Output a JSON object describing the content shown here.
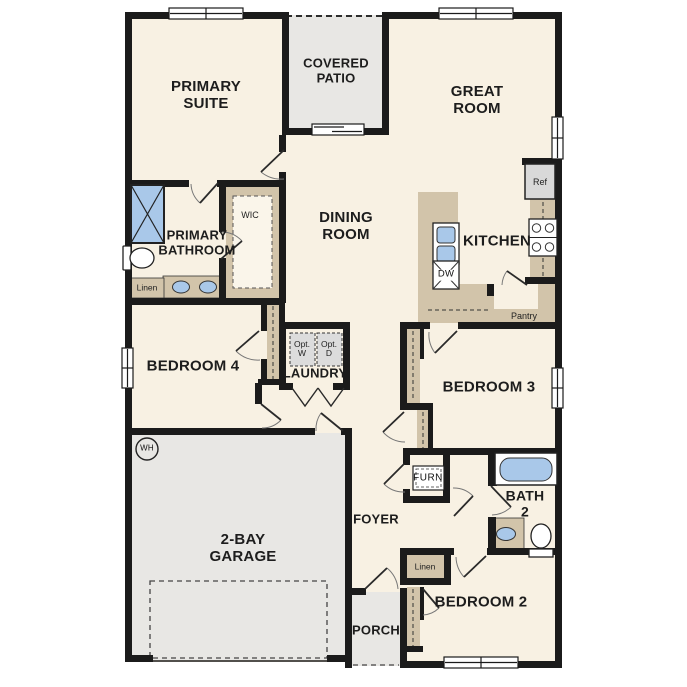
{
  "plan_type": "single-story floor plan",
  "colors": {
    "wall": "#1b1b1b",
    "floor": "#f8f1e3",
    "outdoor_concrete": "#e8e7e4",
    "casework_tan": "#d2c4aa",
    "fixture_blue": "#a9c8e9",
    "appliance_gray": "#d9d9d9"
  },
  "labels": {
    "primary_suite": "PRIMARY\nSUITE",
    "covered_patio": "COVERED\nPATIO",
    "great_room": "GREAT\nROOM",
    "dining_room": "DINING\nROOM",
    "kitchen": "KITCHEN",
    "ref": "Ref",
    "dw": "DW",
    "pantry": "Pantry",
    "primary_bathroom": "PRIMARY\nBATHROOM",
    "wic": "WIC",
    "linen_bath": "Linen",
    "bedroom4": "BEDROOM 4",
    "laundry": "LAUNDRY",
    "opt_w": "Opt.\nW",
    "opt_d": "Opt.\nD",
    "bedroom3": "BEDROOM 3",
    "water_heater": "WH",
    "garage": "2-BAY\nGARAGE",
    "furnace": "FURN",
    "foyer": "FOYER",
    "bath2": "BATH\n2",
    "linen_hall": "Linen",
    "bedroom2": "BEDROOM 2",
    "porch": "PORCH"
  }
}
